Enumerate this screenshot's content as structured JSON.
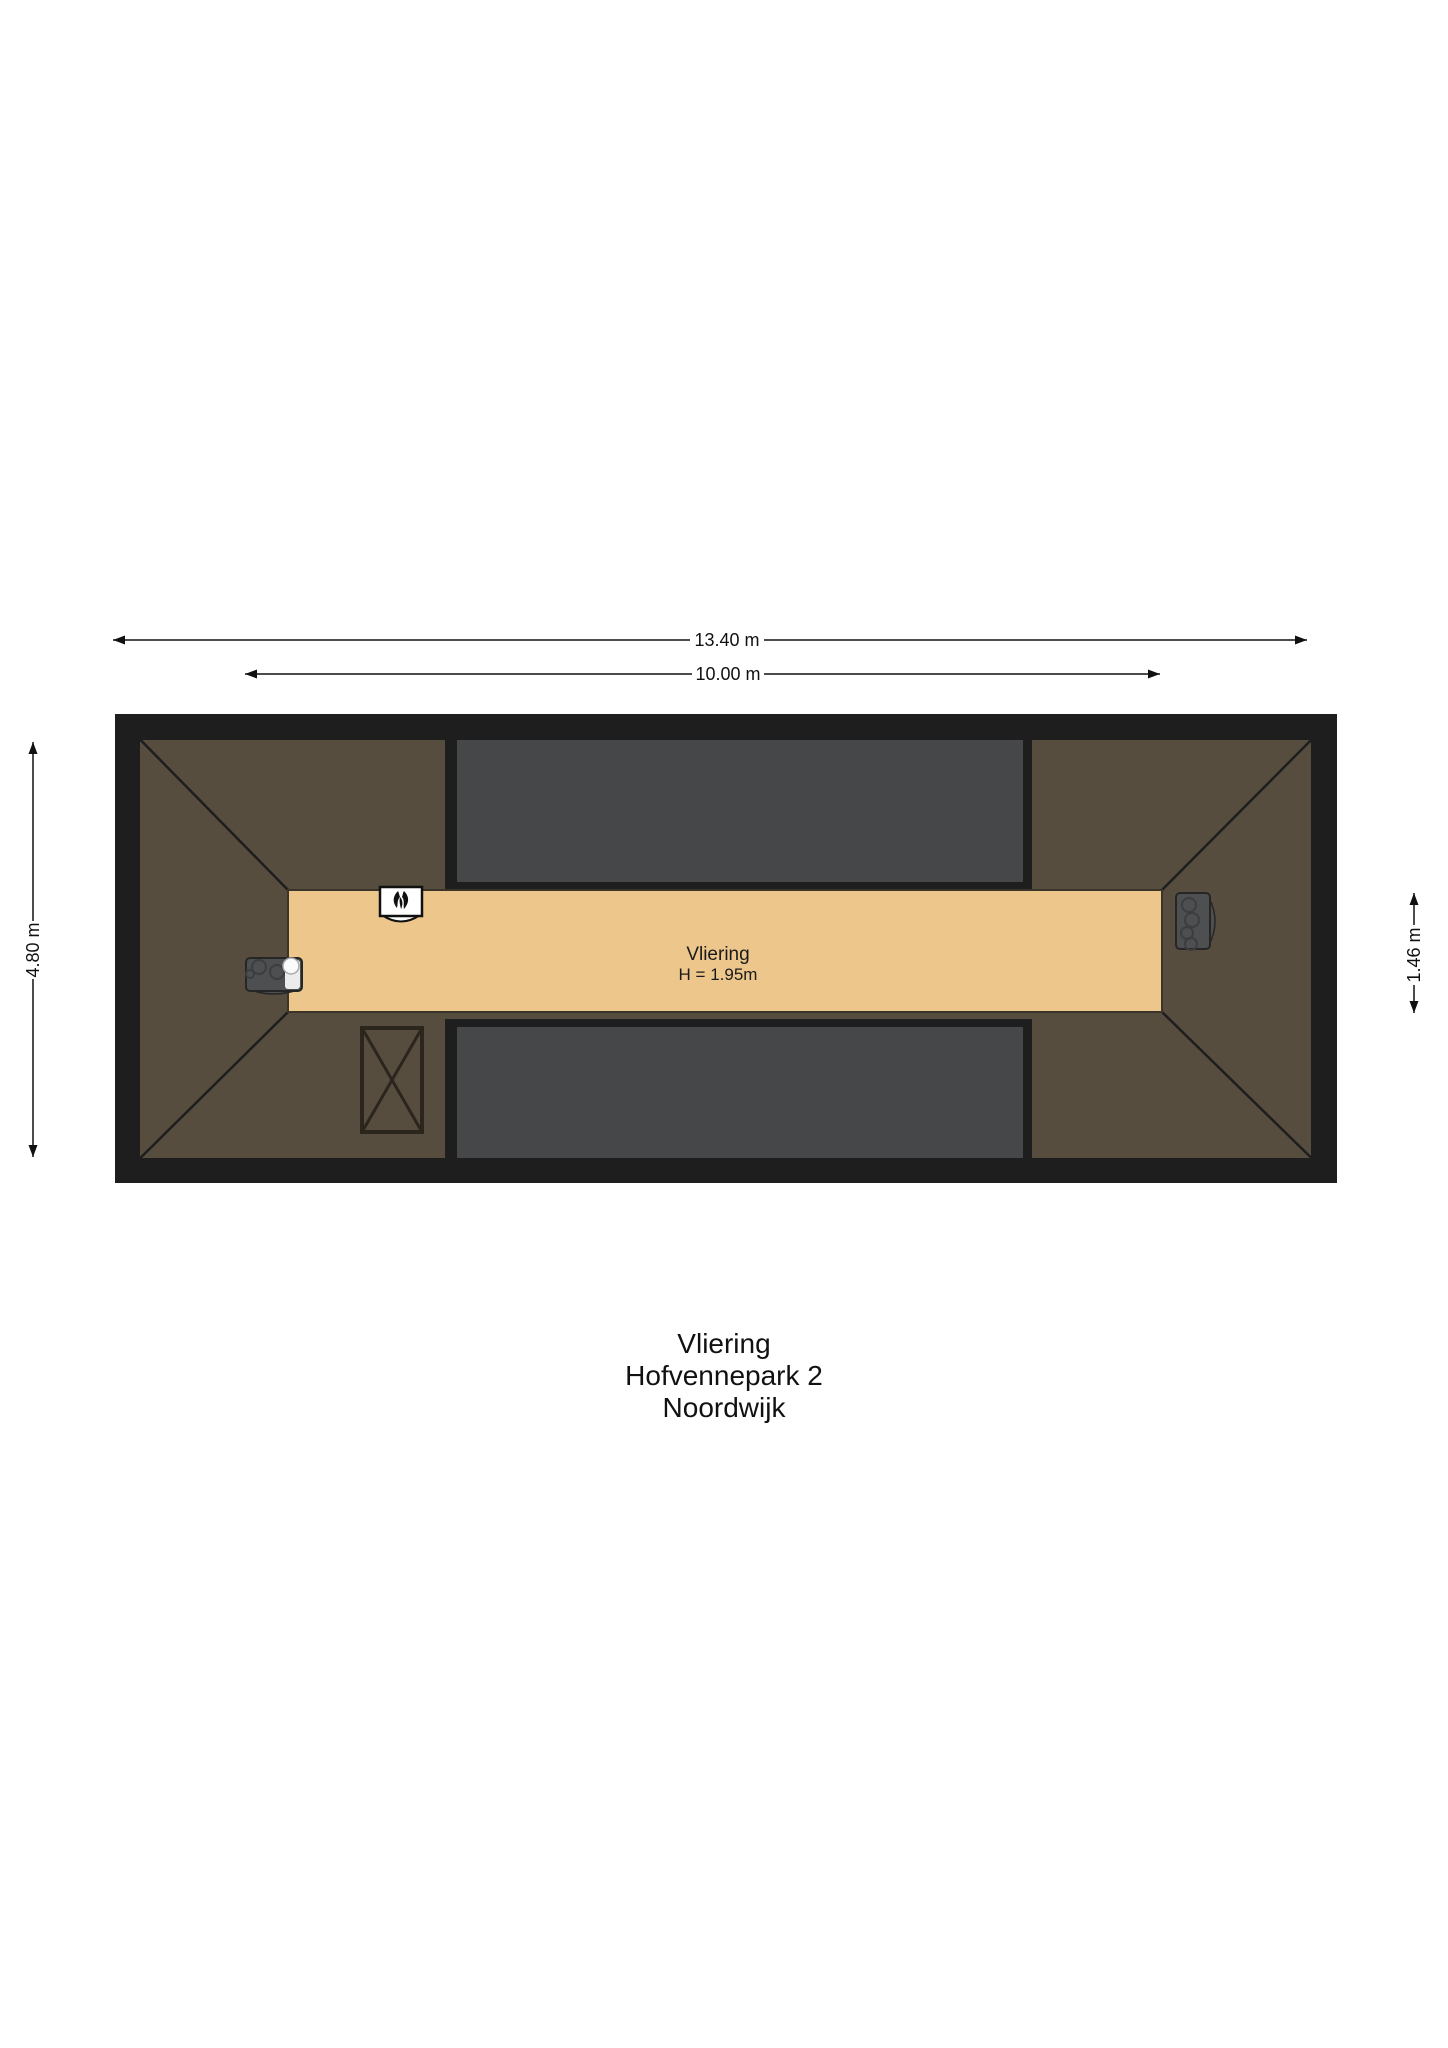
{
  "colors": {
    "background": "#ffffff",
    "outline_black": "#1e1e1e",
    "roof_brown": "#564d3e",
    "roof_section_gray": "#464749",
    "floor_tan": "#edc68c",
    "strip_border": "#3b3428",
    "appliance_gray": "#4e4f51",
    "appliance_outline": "#262626",
    "text_black": "#111111"
  },
  "dimensions": {
    "total_width": "13.40 m",
    "inner_width": "10.00 m",
    "total_height": "4.80 m",
    "strip_height": "1.46 m"
  },
  "room": {
    "name": "Vliering",
    "height": "H = 1.95m"
  },
  "title": {
    "room": "Vliering",
    "address": "Hofvennepark 2",
    "city": "Noordwijk"
  },
  "icons": {
    "ventilation": "mechanical-ventilation-icon",
    "boiler_left": "boiler-icon",
    "boiler_right": "boiler-icon",
    "hatch": "roof-hatch-icon"
  }
}
